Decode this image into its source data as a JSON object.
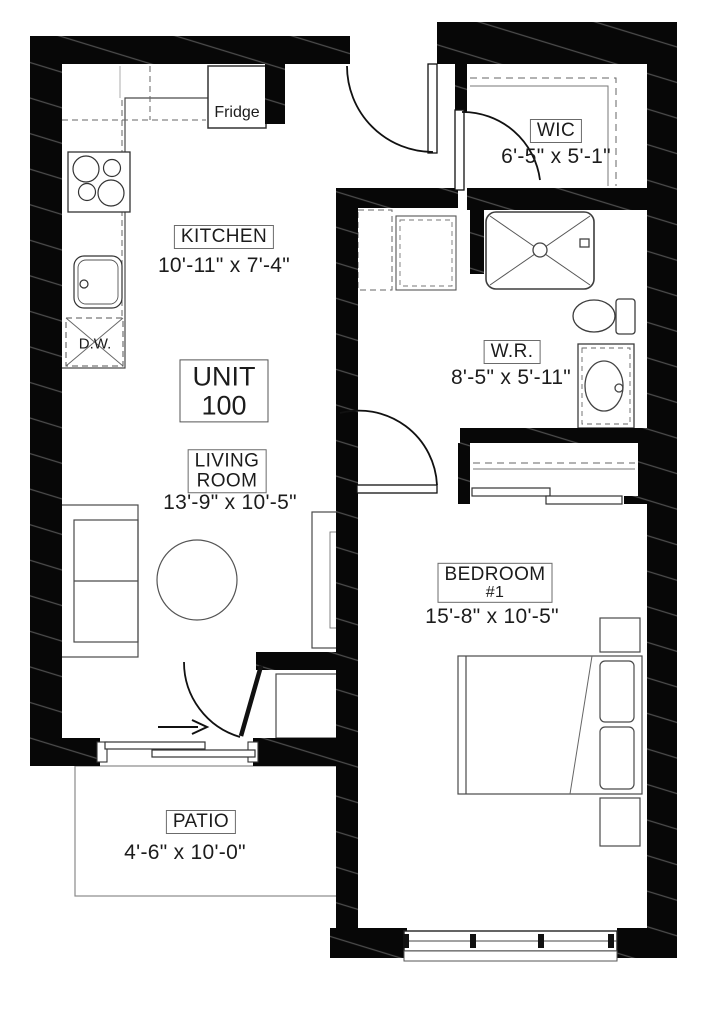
{
  "plan": {
    "unit": {
      "line1": "UNIT",
      "line2": "100"
    },
    "rooms": {
      "kitchen": {
        "name": "KITCHEN",
        "dims": "10'-11\" x 7'-4\""
      },
      "wic": {
        "name": "WIC",
        "dims": "6'-5\" x 5'-1\""
      },
      "wr": {
        "name": "W.R.",
        "dims": "8'-5\" x 5'-11\""
      },
      "living": {
        "line1": "LIVING",
        "line2": "ROOM",
        "dims": "13'-9\" x 10'-5\""
      },
      "bedroom": {
        "line1": "BEDROOM",
        "line2": "#1",
        "dims": "15'-8\" x 10'-5\""
      },
      "patio": {
        "name": "PATIO",
        "dims": "4'-6\" x 10'-0\""
      }
    },
    "appliances": {
      "fridge": "Fridge",
      "dishwasher": "D.W."
    },
    "colors": {
      "wall": "#000000",
      "line": "#444444",
      "background": "#ffffff"
    }
  }
}
